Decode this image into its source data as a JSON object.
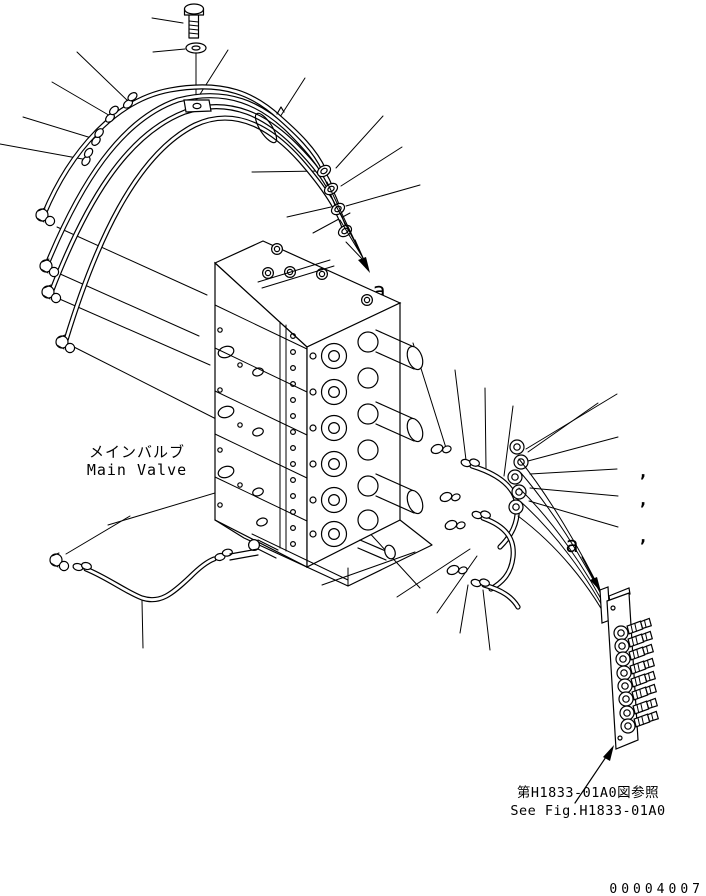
{
  "figure": {
    "kind": "hydraulic-parts-diagram",
    "background_color": "#ffffff",
    "line_color": "#000000"
  },
  "labels": {
    "main_valve_jp": "メインバルブ",
    "main_valve_en": "Main Valve",
    "section_arrow_top": "a",
    "section_arrow_right": "a",
    "see_fig_jp": "第H1833-01A0図参照",
    "see_fig_en": "See Fig.H1833-01A0",
    "drawing_number": "00004007",
    "callout_commas": [
      ",",
      ",",
      ","
    ]
  },
  "components": {
    "bolt": "mounting-bolt",
    "washer": "washer",
    "clamp_plate": "hose-clamp-plate",
    "band_clamp": "hose-band-clamp",
    "hose_bundle": "pilot-hose-bundle",
    "elbow_fittings": "elbow-fittings",
    "valve_block": "main-control-valve-block",
    "lower_hose": "lower-pilot-hose",
    "nipple_fittings": "nipple-fittings",
    "elbow_stack": "right-elbow-fittings",
    "manifold": "multi-port-manifold-block"
  }
}
